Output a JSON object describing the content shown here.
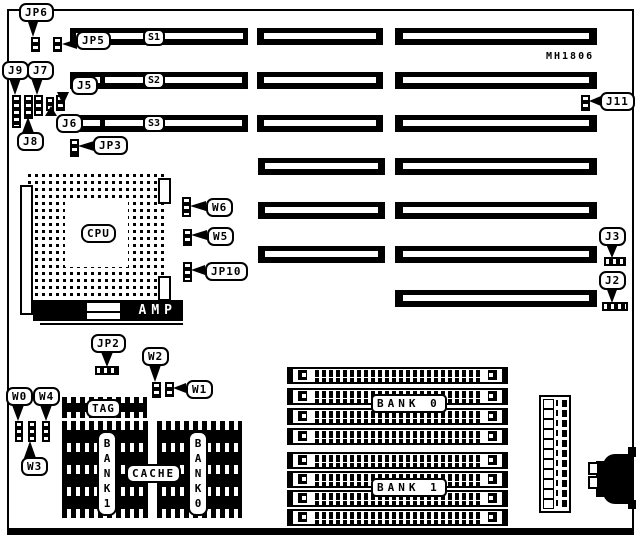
{
  "model": "MH1806",
  "labels": {
    "jp6": "JP6",
    "jp5": "JP5",
    "j9": "J9",
    "j7": "J7",
    "j5": "J5",
    "j6": "J6",
    "j8": "J8",
    "jp3": "JP3",
    "j11": "J11",
    "j3": "J3",
    "j2": "J2",
    "w6": "W6",
    "w5": "W5",
    "jp10": "JP10",
    "jp2": "JP2",
    "w2": "W2",
    "w1": "W1",
    "w0": "W0",
    "w4": "W4",
    "w3": "W3",
    "s1": "S1",
    "s2": "S2",
    "s3": "S3",
    "cpu": "CPU",
    "amp": "AMP",
    "tag": "TAG",
    "cache": "CACHE",
    "cache_bank1_vertical": "BANK1",
    "cache_bank0_vertical": "BANK0",
    "mem_bank0": "BANK 0",
    "mem_bank1": "BANK 1"
  },
  "colors": {
    "ink": "#000000",
    "paper": "#ffffff"
  }
}
